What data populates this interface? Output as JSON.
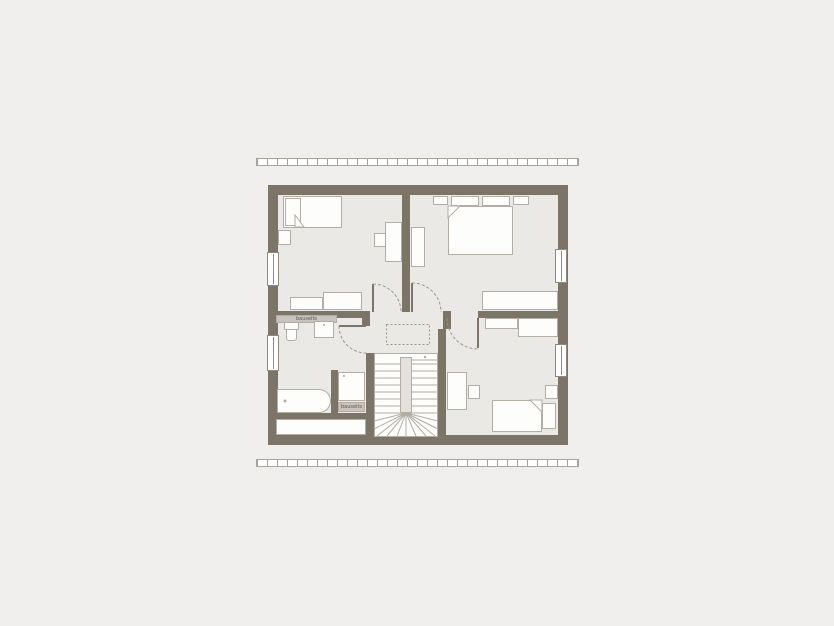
{
  "canvas": {
    "width": 834,
    "height": 626,
    "background": "#f0efed"
  },
  "plan": {
    "type": "attic-floor-plan",
    "rooms": [
      "bedroom-top-left",
      "bedroom-top-right",
      "bathroom",
      "hallway",
      "staircase",
      "bedroom-bottom-right"
    ],
    "fixtures": [
      "single-bed",
      "double-bed",
      "desk",
      "chair",
      "wardrobe",
      "sideboard",
      "toilet",
      "sink",
      "bathtub",
      "shower",
      "winder-stairs"
    ],
    "door_count": 4,
    "window_count": 4
  },
  "labels": {
    "bath_shelf": "bauseits",
    "shower_shelf": "bauseits"
  },
  "colors": {
    "bg": "#f0efed",
    "wall": "#7d7468",
    "floor": "#ebe9e5",
    "furn-fill": "#fdfdfc",
    "furn-border": "#b2ada5",
    "shelf-fill": "#c8c4bd",
    "shelf-text": "#5b564f",
    "window-fill": "#ffffff",
    "dash": "#9b968f",
    "stair-line": "#b2ada5",
    "hatch-line": "#a8a49d"
  }
}
